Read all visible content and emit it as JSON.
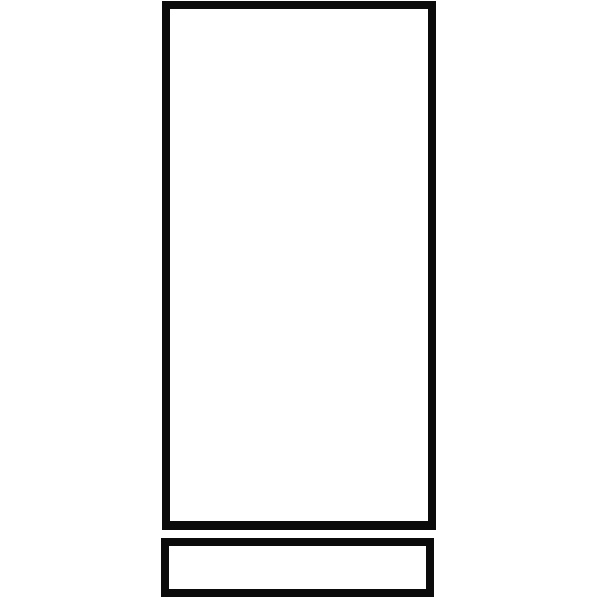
{
  "figure": {
    "description": "Black outline line drawing: a tall vertical rectangle with a short horizontal rectangle directly beneath it, separated by a thin white gap",
    "background_color": "#ffffff",
    "stroke_color": "#0b0b0b",
    "shapes": [
      {
        "name": "large-rectangle-outline",
        "fill": "#ffffff",
        "stroke": "#0b0b0b",
        "label": ""
      },
      {
        "name": "small-rectangle-outline",
        "fill": "#ffffff",
        "stroke": "#0b0b0b",
        "label": ""
      }
    ]
  }
}
